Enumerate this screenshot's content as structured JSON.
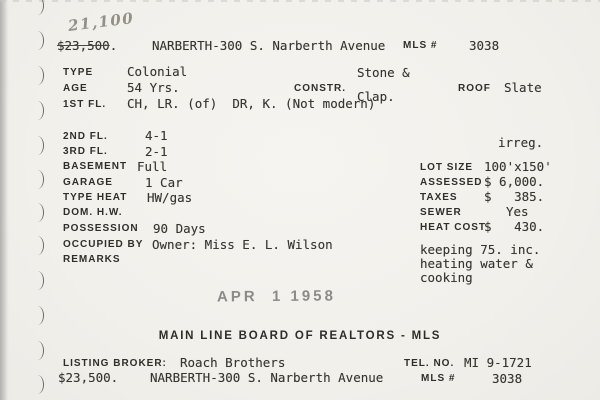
{
  "pencil_note": "21,100",
  "header": {
    "price_struck": "$23,500",
    "price_period": ".",
    "address": "NARBERTH-300 S. Narberth Avenue",
    "mls_label": "MLS #",
    "mls_number": "3038"
  },
  "top_fields": {
    "type": {
      "label": "TYPE",
      "value": "Colonial"
    },
    "age": {
      "label": "AGE",
      "value": "54 Yrs."
    },
    "constr": {
      "label": "CONSTR.",
      "line1": "Stone &",
      "line2": "Clap."
    },
    "roof": {
      "label": "ROOF",
      "value": "Slate"
    },
    "first_fl": {
      "label": "1ST FL.",
      "value": "CH, LR. (of)  DR, K. (Not modern)"
    }
  },
  "left_fields": [
    {
      "label": "2ND FL.",
      "value": "4-1"
    },
    {
      "label": "3RD FL.",
      "value": "2-1"
    },
    {
      "label": "BASEMENT",
      "value": "Full"
    },
    {
      "label": "GARAGE",
      "value": "1 Car"
    },
    {
      "label": "TYPE HEAT",
      "value": "HW/gas"
    },
    {
      "label": "DOM. H.W.",
      "value": ""
    },
    {
      "label": "POSSESSION",
      "value": "90 Days"
    },
    {
      "label": "OCCUPIED BY",
      "value": "Owner: Miss E. L. Wilson"
    },
    {
      "label": "REMARKS",
      "value": ""
    }
  ],
  "right_fields": {
    "irregular": "irreg.",
    "lot_size": {
      "label": "LOT SIZE",
      "value": "100'x150'"
    },
    "assessed": {
      "label": "ASSESSED",
      "value": "$ 6,000."
    },
    "taxes": {
      "label": "TAXES",
      "value": "$   385."
    },
    "sewer": {
      "label": "SEWER",
      "value": "Yes"
    },
    "heat_cost": {
      "label": "HEAT COST",
      "value": "$   430."
    },
    "note_line1": "keeping 75. inc.",
    "note_line2": "heating water &",
    "note_line3": "cooking"
  },
  "stamp_date": "APR  1 1958",
  "org_line": "MAIN LINE BOARD OF REALTORS - MLS",
  "footer": {
    "broker_label": "LISTING BROKER:",
    "broker_value": "Roach Brothers",
    "tel_label": "TEL. NO.",
    "tel_value": "MI 9-1721",
    "price": "$23,500.",
    "address": "NARBERTH-300 S. Narberth Avenue",
    "mls_label": "MLS #",
    "mls_number": "3038"
  }
}
